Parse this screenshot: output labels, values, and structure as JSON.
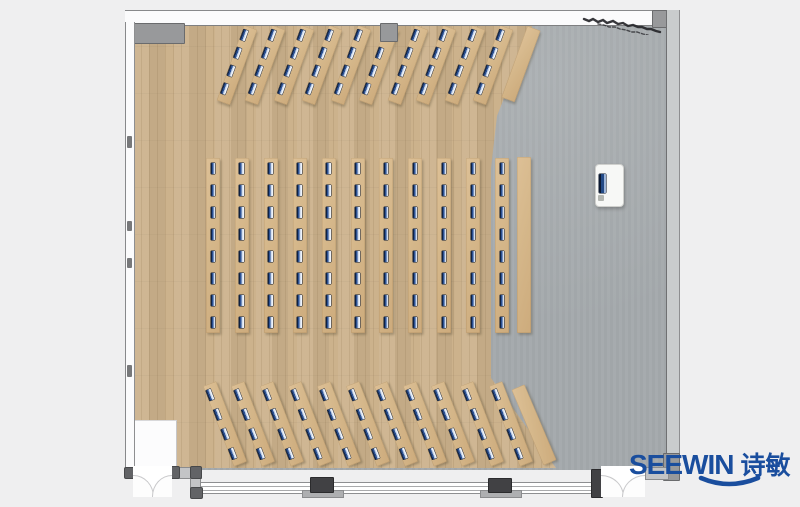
{
  "scene": {
    "title": "Classroom training-room floor plan (top view)",
    "room_type": "lecture / computer training room"
  },
  "branding": {
    "name": "SEEWIN",
    "cjk": "诗敏",
    "color": "#1a4e9e"
  },
  "palette": {
    "page_bg": "#efeff0",
    "wood_floor": "#ccb28c",
    "gray_floor": "#a4a9ac",
    "desk_tan": "#d5b78a",
    "monitor_navy": "#1e3c72",
    "wall_line": "#808184",
    "wall_block": "#98999b",
    "column_dark": "#414144"
  },
  "furniture": {
    "total_long_desks": 32,
    "total_side_tables": 3,
    "total_monitors": 172,
    "sections": [
      {
        "id": "front-row",
        "desks": 10,
        "monitors_per_desk": 4,
        "angle": 20,
        "first_left": 229.5,
        "top": 24.5,
        "spacing": 28.5,
        "desk_w": 13.5,
        "desk_h": 80,
        "monitor_x": 1.2,
        "monitor_ys": [
          4,
          23,
          42,
          61
        ],
        "plain": {
          "left": 514,
          "top": 26,
          "w": 13.5,
          "h": 76,
          "angle": 20
        }
      },
      {
        "id": "center-grid",
        "desks": 11,
        "monitors_per_desk": 8,
        "angle": 0,
        "first_left": 206,
        "top": 158,
        "spacing": 28.9,
        "desk_w": 14,
        "desk_h": 175,
        "monitor_x": 4.5,
        "monitor_ys": [
          5,
          27,
          49,
          71,
          93,
          115,
          137,
          159
        ],
        "plain": {
          "left": 517,
          "top": 157,
          "w": 14,
          "h": 176,
          "angle": 0
        }
      },
      {
        "id": "back-row",
        "desks": 11,
        "monitors_per_desk": 4,
        "angle": -21,
        "first_left": 217.5,
        "top": 381,
        "spacing": 28.6,
        "desk_w": 13.5,
        "desk_h": 86,
        "monitor_x": 1.2,
        "monitor_ys": [
          5,
          26,
          47,
          68
        ],
        "plain": {
          "left": 527,
          "top": 384,
          "w": 13.5,
          "h": 82,
          "angle": -23
        }
      }
    ],
    "podium": {
      "x": 595,
      "y": 164,
      "w": 27,
      "h": 41,
      "has_screen": true
    }
  },
  "architecture": {
    "doors": [
      {
        "id": "door-left",
        "type": "double-swing",
        "x": 133,
        "width": 39
      },
      {
        "id": "door-right",
        "type": "double-swing",
        "x": 601,
        "width": 44
      }
    ],
    "wall_columns_x": [
      311,
      489,
      592
    ],
    "glazed_wall": "bottom",
    "sketch_mark": "dark scribble near top-right corner"
  }
}
